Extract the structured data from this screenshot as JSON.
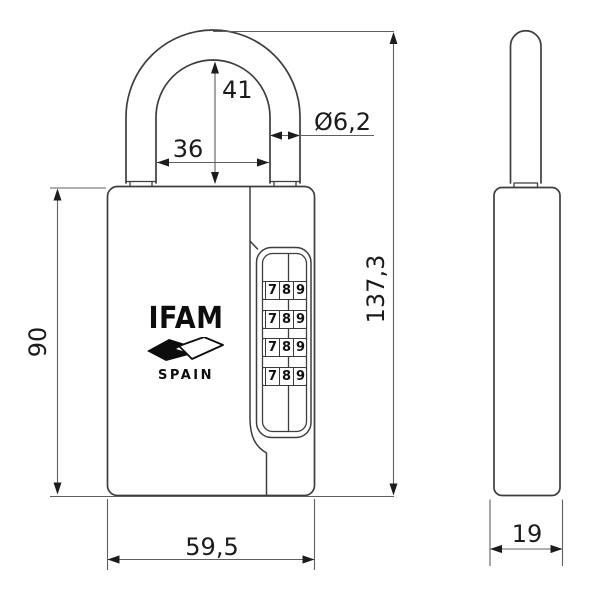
{
  "meta": {
    "title": "Combination padlock dimensional drawing"
  },
  "brand": {
    "name": "IFAM",
    "country": "SPAIN"
  },
  "dimensions": {
    "shackle_inner_height": {
      "label": "41"
    },
    "shackle_inner_width": {
      "label": "36"
    },
    "shackle_diameter": {
      "label": "Ø6,2"
    },
    "body_height": {
      "label": "90"
    },
    "total_height": {
      "label": "137,3"
    },
    "body_width": {
      "label": "59,5"
    },
    "body_depth": {
      "label": "19"
    }
  },
  "wheels": {
    "rows": [
      [
        "7",
        "8",
        "9"
      ],
      [
        "7",
        "8",
        "9"
      ],
      [
        "7",
        "8",
        "9"
      ],
      [
        "7",
        "8",
        "9"
      ]
    ]
  },
  "colors": {
    "object_line": "#3e3e3e",
    "dimension_line": "#5f5f5f",
    "text": "#1b1b1b",
    "background": "#ffffff"
  }
}
